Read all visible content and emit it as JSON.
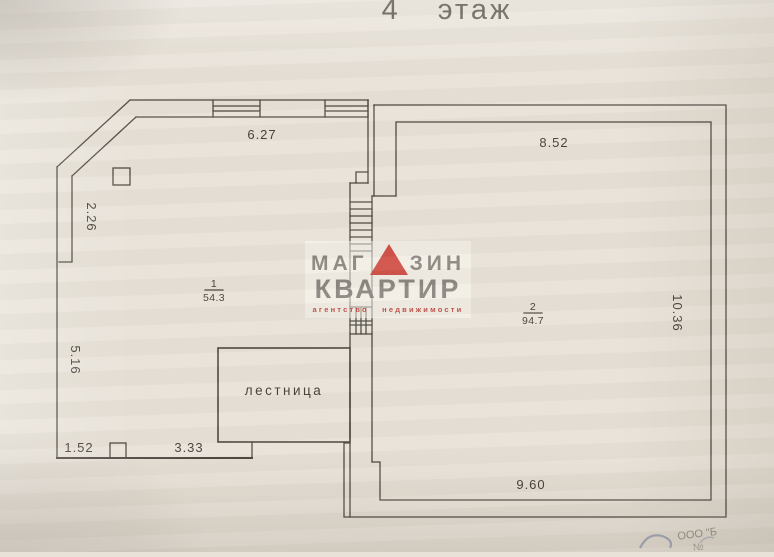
{
  "title": "4 этаж",
  "plan": {
    "rooms": [
      {
        "number": "1",
        "area": "54.3"
      },
      {
        "number": "2",
        "area": "94.7"
      }
    ],
    "stair_label": "лестница",
    "dimensions": {
      "top_left": "6.27",
      "top_right": "8.52",
      "left_upper": "2.26",
      "left_lower": "5.16",
      "bottom_left": "1.52",
      "bottom_center": "3.33",
      "bottom_right": "9.60",
      "right_side": "10.36"
    }
  },
  "watermark": {
    "line1_prefix": "МАГ",
    "line1_suffix": "ЗИН",
    "line2": "КВАРТИР",
    "line3": "агентство недвижимости",
    "triangle_color": "#d05148",
    "text_color": "#8b8680",
    "accent_color": "#c0544b"
  },
  "stamp": {
    "line1": "ООО \"Б",
    "line2": "№"
  },
  "colors": {
    "paper": "#e8e2d8",
    "line": "#4d4840",
    "title": "#5a554c"
  }
}
